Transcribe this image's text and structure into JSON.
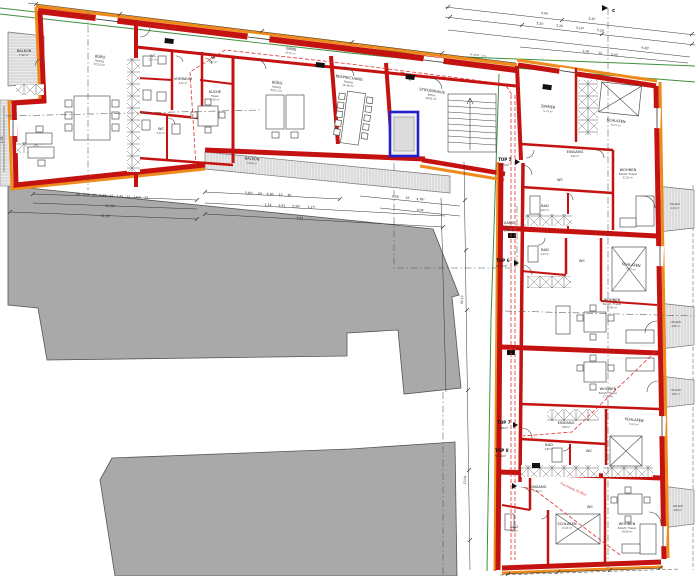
{
  "plan": {
    "type": "architectural-floor-plan",
    "section_marker": "c",
    "slope_note": "GL.NEIG. 1,5%",
    "colors": {
      "wall_red": "#c41211",
      "wall_orange": "#ee8b1c",
      "elevator_blue": "#2222cc",
      "boundary_green": "#3f8f3f",
      "escape_red": "#e03030",
      "neighbor_gray": "#a9a9a9"
    },
    "office": {
      "gang": {
        "name": "GANG",
        "sub": "Fliesen",
        "area": "30,52 m²"
      },
      "fluchtweg": "Fluchtweg 30,60m",
      "balkon_nw": {
        "name": "BALKON",
        "sub": "Holz",
        "area": "7,52 m²"
      },
      "buero1": {
        "name": "BÜRO",
        "sub": "Parkett",
        "area": "77,03 m²"
      },
      "wc1": {
        "name": "WC",
        "sub": "Fliesen",
        "area": "2,11 m²"
      },
      "wc2": {
        "name": "WC",
        "sub": "Fliesen",
        "area": "2,11 m²"
      },
      "vorraum": {
        "name": "VORRAUM",
        "sub": "Fliesen",
        "area": "4,32 m²"
      },
      "ar": {
        "name": "AR",
        "sub": "Fliesen",
        "area": "1,42 m²"
      },
      "kueche": {
        "name": "KÜCHE",
        "sub": "Fliesen",
        "area": "6,28 m²"
      },
      "buero2": {
        "name": "BÜRO",
        "sub": "Parkett",
        "area": "34,01 m²"
      },
      "besprechung": {
        "name": "BESPRECHUNG",
        "sub": "Parkett",
        "area": "14,36 m²"
      },
      "stiegenhaus": {
        "name": "STIEGENHAUS",
        "sub": "Beton",
        "area": "30,81 m²"
      },
      "balkon_s": {
        "name": "BALKON",
        "sub": "Holz",
        "area": "13,86 m²"
      }
    },
    "wing": {
      "gang": {
        "name": "GANG",
        "sub": "Fliesen",
        "area": "63,47 m²"
      },
      "fluchtweg": "Fluchtweg 35,80m",
      "top5": {
        "id": "TOP 5",
        "area": "71,29m²"
      },
      "top6": {
        "id": "TOP 6",
        "area": "55,96m²"
      },
      "top7": {
        "id": "TOP 7",
        "area": "60,96m²"
      },
      "top8": {
        "id": "TOP 8",
        "area": "54,39m²"
      },
      "t5_zimmer": {
        "name": "ZIMMER",
        "sub": "Parkett",
        "area": "11,23 m²"
      },
      "t5_schlafen": {
        "name": "SCHLAFEN",
        "sub": "Parkett",
        "area": "14,07 m²"
      },
      "t5_eingang": {
        "name": "EINGANG",
        "sub": "Fliesen",
        "area": "4,62 m²"
      },
      "t5_wc": {
        "name": "WC",
        "sub": "Fliesen",
        "area": "1,60 m²"
      },
      "t5_bad": {
        "name": "BAD",
        "sub": "Fliesen",
        "area": "4,60 m²"
      },
      "t5_wohnen": {
        "name": "WOHNEN",
        "sub": "Parkett / Fliesen",
        "area": "32,55 m²"
      },
      "t5_balkon": {
        "name": "BALKON",
        "sub": "Holz",
        "area": "4,20 m²"
      },
      "t6_bad": {
        "name": "BAD",
        "sub": "Fliesen",
        "area": "5,43 m²"
      },
      "t6_wc": {
        "name": "WC",
        "sub": "Fliesen",
        "area": "1,60 m²"
      },
      "t6_schlafen": {
        "name": "SCHLAFEN",
        "sub": "Parkett",
        "area": "13,01 m²"
      },
      "t6_wohnen": {
        "name": "WOHNEN",
        "sub": "Parkett / Fliesen",
        "area": "27,80 m²"
      },
      "t6_balkon": {
        "name": "BALKON",
        "sub": "Holz",
        "area": "4,86 m²"
      },
      "t7_wohnen": {
        "name": "WOHNEN",
        "sub": "Parkett / Fliesen",
        "area": "27,80 m²"
      },
      "t7_eingang": {
        "name": "EINGANG",
        "sub": "Fliesen",
        "area": "7,68 m²"
      },
      "t7_schlafen": {
        "name": "SCHLAFEN",
        "sub": "Parkett",
        "area": "13,01 m²"
      },
      "t7_bad": {
        "name": "BAD",
        "sub": "Fliesen",
        "area": "4,80 m²"
      },
      "t7_wc": {
        "name": "WC",
        "sub": "Fliesen",
        "area": "1,55 m²"
      },
      "t7_balkon": {
        "name": "BALKON",
        "sub": "Holz",
        "area": "4,86 m²"
      },
      "t8_eingang": {
        "name": "EINGANG",
        "sub": "Fliesen",
        "area": "6,63 m²"
      },
      "t8_bad": {
        "name": "BAD",
        "sub": "Fliesen",
        "area": "7,04 m²"
      },
      "t8_wc": {
        "name": "WC",
        "sub": "Fliesen",
        "area": "1,55 m²"
      },
      "t8_schlafen": {
        "name": "SCHLAFEN",
        "sub": "Parkett",
        "area": "13,13 m²"
      },
      "t8_wohnen": {
        "name": "WOHNEN",
        "sub": "Parkett / Fliesen",
        "area": "26,60 m²"
      },
      "t8_balkon": {
        "name": "BALKON",
        "sub": "Holz",
        "area": "4,86 m²"
      }
    },
    "dims": {
      "top_row1": "4,40 5,20",
      "top_row2": "5,20 2,20 3,10² 5,20",
      "top_row3": "4,42²",
      "top_row4": "1,09 12 5,00",
      "grayL1": "45 3,59 45 5,62 37 1,45 12 1,63² 12",
      "grayL2": "12,30²",
      "grayL3": "11,36",
      "grayM1": "3,40² 29 4,90 12 40",
      "grayM2": "1,14 3,61 5,50² 1,17²",
      "grayM3": "9,41",
      "grayR1": "2,39 26 4,78²",
      "grayR2": "4,04",
      "vRight1": "30,13",
      "vRight2": "13,01",
      "leftV": "1,06"
    }
  }
}
